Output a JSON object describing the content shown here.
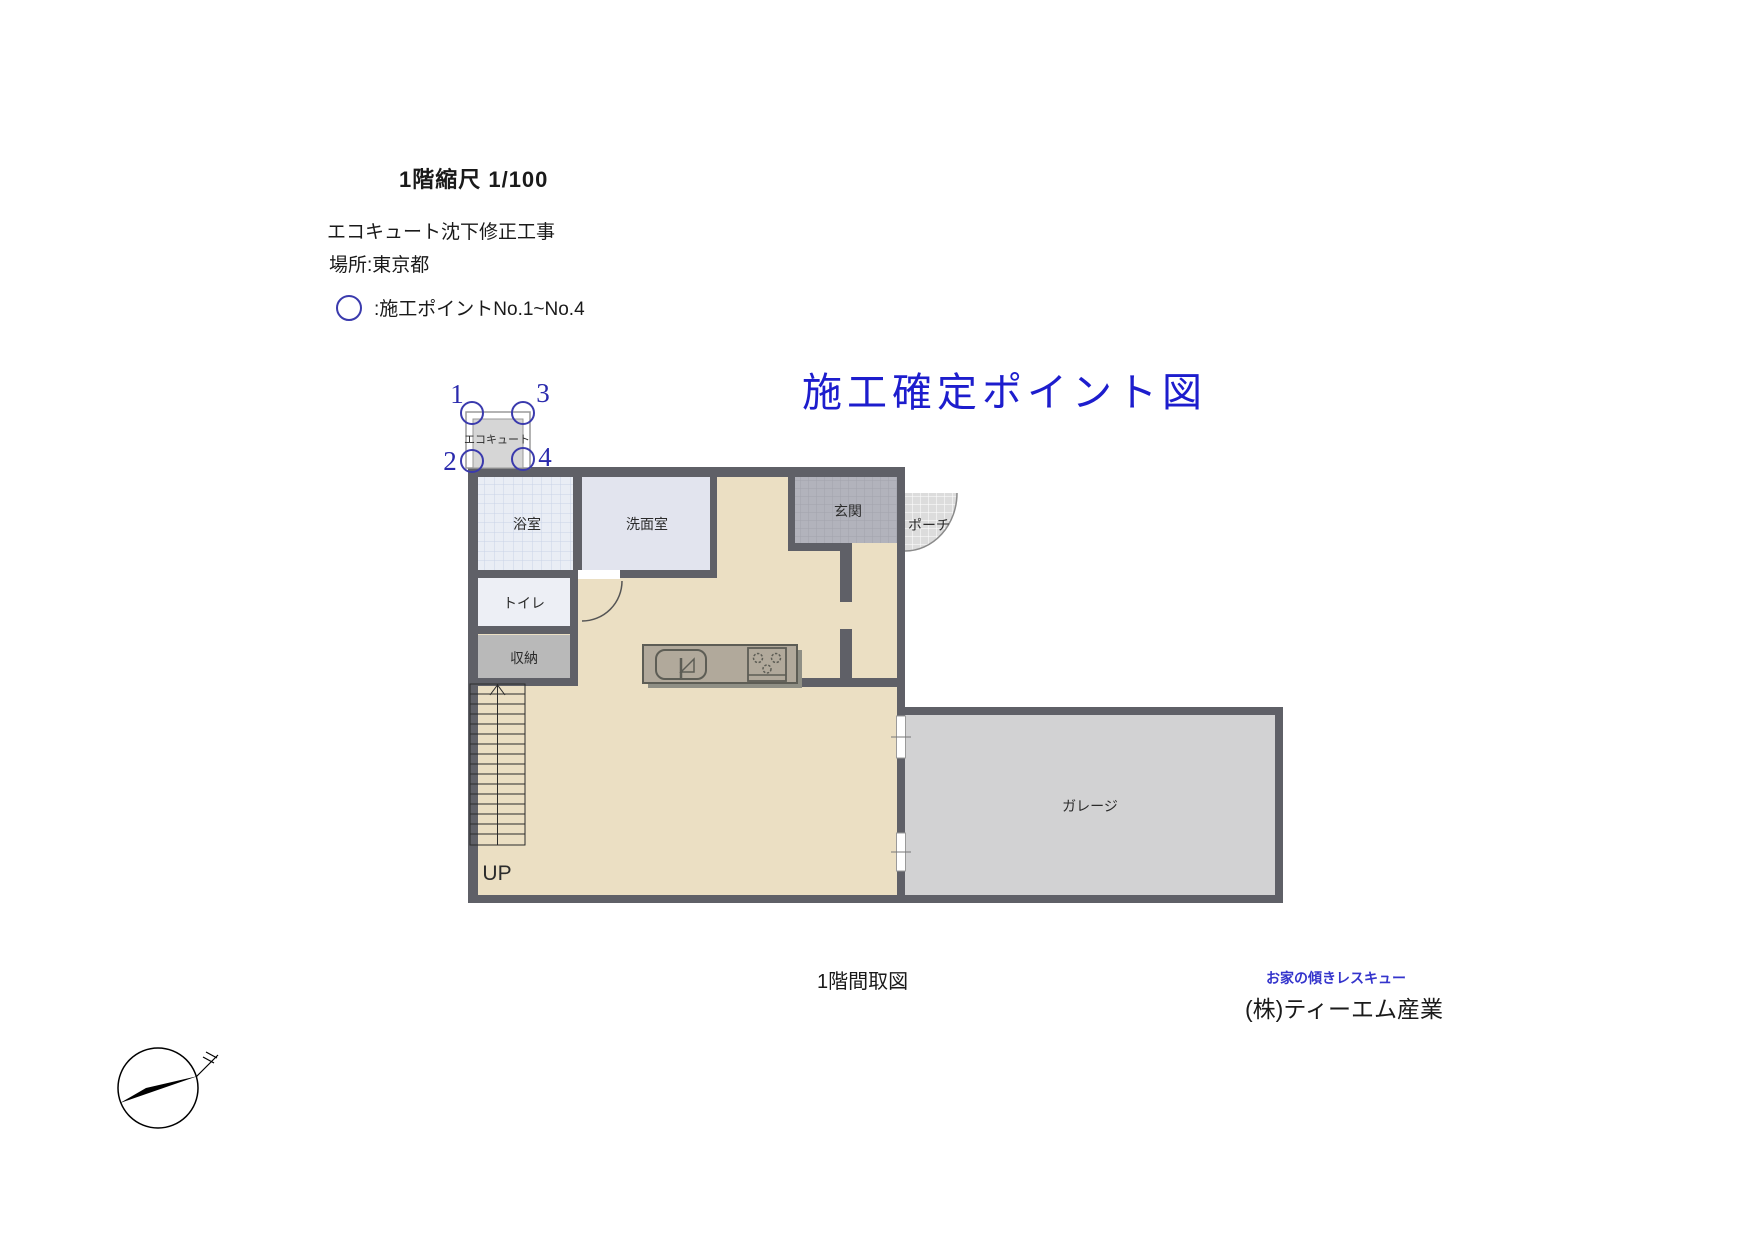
{
  "header": {
    "scale_title": "1階縮尺 1/100",
    "project_line1": "エコキュート沈下修正工事",
    "project_line2": "場所:東京都",
    "legend_text": ":施工ポイントNo.1~No.4",
    "main_title": "施工確定ポイント図"
  },
  "plan": {
    "rooms": {
      "ecocute": "エコキュート",
      "bath": "浴室",
      "washroom": "洗面室",
      "toilet": "トイレ",
      "storage": "収納",
      "entrance": "玄関",
      "porch": "ポーチ",
      "garage": "ガレージ"
    },
    "stairs_label": "UP",
    "points": [
      "1",
      "2",
      "3",
      "4"
    ]
  },
  "footer": {
    "plan_caption": "1階間取図",
    "company_tagline": "お家の傾きレスキュー",
    "company_name": "(株)ティーエム産業"
  },
  "colors": {
    "title_blue": "#1d1dcd",
    "point_blue": "#3a3aad",
    "wall_gray": "#5f6067",
    "floor_beige": "#ebdfc3",
    "garage_gray": "#d2d2d3",
    "bath_fill": "#e9edf5",
    "washroom_fill": "#e2e4ee",
    "toilet_fill": "#edeff5",
    "storage_fill": "#b9b9b9",
    "entrance_fill": "#b2b3bc",
    "porch_fill": "#dcdcdc",
    "counter_fill": "#b1a99b"
  }
}
